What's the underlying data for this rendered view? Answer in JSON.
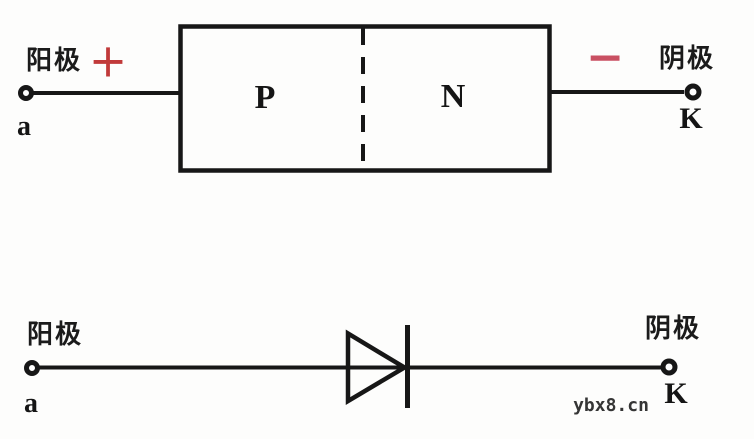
{
  "figure": {
    "background_color": "#fdfdfc",
    "line_color": "#171717",
    "plus_color": "#c13a3a",
    "minus_color": "#c95062"
  },
  "pn_junction_diagram": {
    "anode_label": "阳极",
    "plus_sign": "+",
    "anode_terminal": "a",
    "p_region": "P",
    "n_region": "N",
    "minus_sign": "−",
    "cathode_label": "阴极",
    "cathode_terminal": "K"
  },
  "diode_symbol_diagram": {
    "anode_label": "阳极",
    "anode_terminal": "a",
    "cathode_label": "阴极",
    "cathode_terminal": "K"
  },
  "watermark": "ybx8.cn"
}
